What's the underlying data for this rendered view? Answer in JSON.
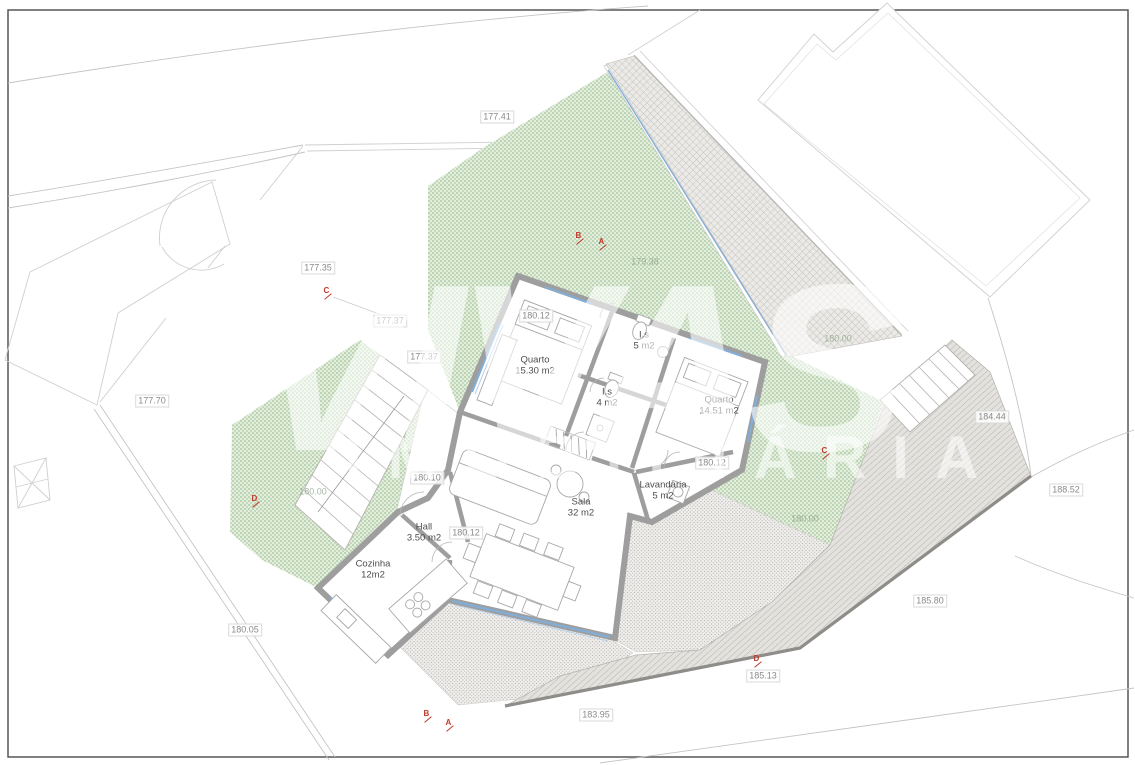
{
  "watermark": {
    "line1": "VIVAS",
    "line2": "IMOBILIÁRIA",
    "registered": "®"
  },
  "colors": {
    "green_base": "#e3eedd",
    "green_dot": "#9fc295",
    "hatch_base": "#eceae7",
    "hatch_line": "#b8b5b0",
    "slope_base": "#e4e2de",
    "slope_line": "#a9a6a0",
    "stipple_base": "#f0efed",
    "stipple_dot": "#b9b7b3",
    "wall": "#9e9e9e",
    "window": "#82aed6",
    "outline": "#c9c9c9",
    "marker_red": "#c0392b"
  },
  "labels": [
    {
      "text": "177.41",
      "x": 497,
      "y": 117
    },
    {
      "text": "177.35",
      "x": 318,
      "y": 268
    },
    {
      "text": "177.37",
      "x": 390,
      "y": 321
    },
    {
      "text": "177.37",
      "x": 424,
      "y": 357
    },
    {
      "text": "177.70",
      "x": 152,
      "y": 401
    },
    {
      "text": "179.38",
      "x": 645,
      "y": 262,
      "faint": true
    },
    {
      "text": "180.12",
      "x": 536,
      "y": 316
    },
    {
      "text": "180.00",
      "x": 838,
      "y": 339,
      "faint": true
    },
    {
      "text": "180.12",
      "x": 712,
      "y": 463
    },
    {
      "text": "180.10",
      "x": 427,
      "y": 478
    },
    {
      "text": "180.00",
      "x": 313,
      "y": 492,
      "faint": true
    },
    {
      "text": "180.00",
      "x": 805,
      "y": 519,
      "faint": true
    },
    {
      "text": "180.12",
      "x": 466,
      "y": 533
    },
    {
      "text": "180.05",
      "x": 245,
      "y": 630
    },
    {
      "text": "184.44",
      "x": 992,
      "y": 417
    },
    {
      "text": "188.52",
      "x": 1066,
      "y": 490
    },
    {
      "text": "185.80",
      "x": 930,
      "y": 601
    },
    {
      "text": "185.13",
      "x": 763,
      "y": 676
    },
    {
      "text": "183.95",
      "x": 596,
      "y": 715
    }
  ],
  "rooms": [
    {
      "name": "Quarto",
      "area": "15.30 m2",
      "x": 535,
      "y": 366
    },
    {
      "name": "I.s",
      "area": "5 m2",
      "x": 644,
      "y": 341
    },
    {
      "name": "I.s",
      "area": "4 m2",
      "x": 607,
      "y": 398
    },
    {
      "name": "Quarto",
      "area": "14.51 m2",
      "x": 719,
      "y": 406
    },
    {
      "name": "Lavandaria",
      "area": "5 m2",
      "x": 663,
      "y": 491
    },
    {
      "name": "Sala",
      "area": "32 m2",
      "x": 581,
      "y": 508
    },
    {
      "name": "Hall",
      "area": "3.50 m2",
      "x": 424,
      "y": 533
    },
    {
      "name": "Cozinha",
      "area": "12m2",
      "x": 373,
      "y": 570
    }
  ],
  "markers": [
    {
      "letter": "C",
      "x": 328,
      "y": 292
    },
    {
      "letter": "B",
      "x": 580,
      "y": 237
    },
    {
      "letter": "A",
      "x": 603,
      "y": 243
    },
    {
      "letter": "C",
      "x": 826,
      "y": 452
    },
    {
      "letter": "D",
      "x": 256,
      "y": 500
    },
    {
      "letter": "D",
      "x": 758,
      "y": 660
    },
    {
      "letter": "B",
      "x": 428,
      "y": 715
    },
    {
      "letter": "A",
      "x": 450,
      "y": 724
    }
  ]
}
